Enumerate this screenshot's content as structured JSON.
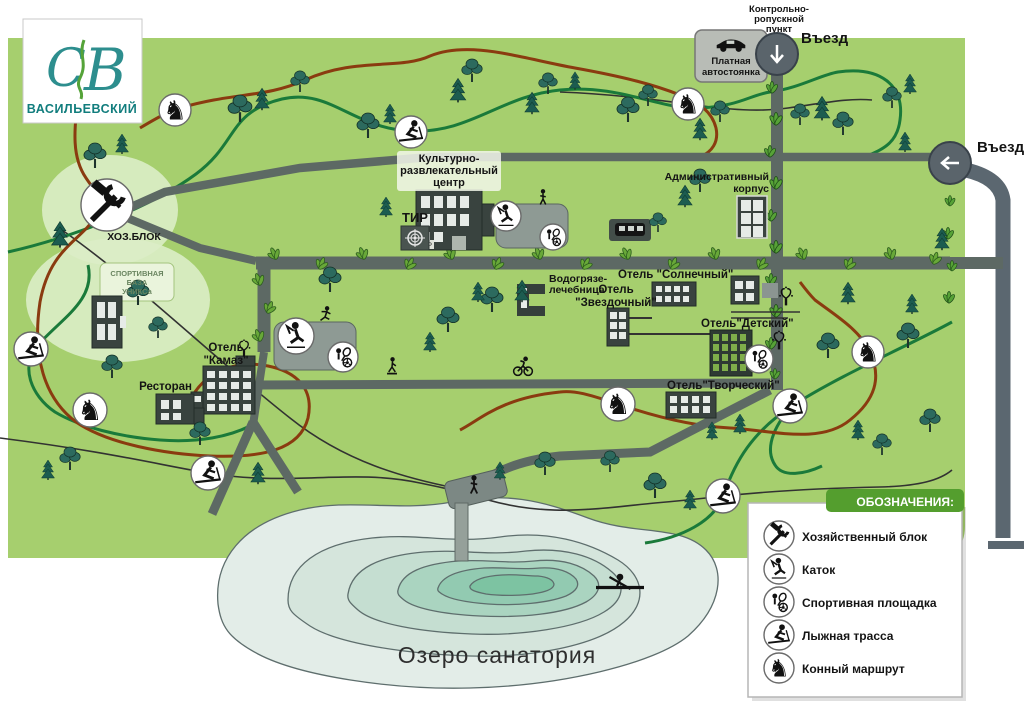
{
  "logo": {
    "monogram_c": "С",
    "monogram_v": "В",
    "name": "ВАСИЛЬЕВСКИЙ"
  },
  "entrances": {
    "top_label": "Въезд",
    "right_label": "Въезд",
    "checkpoint_lines": [
      "Контрольно-",
      "ропускной",
      "пункт"
    ],
    "parking_lines": [
      "Платная",
      "автостоянка"
    ]
  },
  "places": {
    "cultural_lines": [
      "Культурно-",
      "развлекательный",
      "центр"
    ],
    "bar": "БАР",
    "tir": "ТИР",
    "admin_lines": [
      "Административный",
      "корпус"
    ],
    "hoz": "ХОЗ.БЛОК",
    "sport_base_lines": [
      "СПОРТИВНАЯ",
      "БАЗА",
      "УНИКСа"
    ],
    "clinic_lines": [
      "Водогрязе-",
      "лечебница"
    ],
    "hotel_sunny": "Отель \"Солнечный\"",
    "hotel_star_lines": [
      "Отель",
      "\"Звездочный\""
    ],
    "hotel_kids": "Отель\"Детский\"",
    "hotel_creative": "Отель\"Творческий\"",
    "hotel_kamaz_lines": [
      "Отель",
      "\"Камаз\""
    ],
    "restaurant": "Ресторан",
    "lake": "Озеро  санатория"
  },
  "legend": {
    "title": "ОБОЗНАЧЕНИЯ:",
    "items": [
      {
        "icon": "tools-icon",
        "label": "Хозяйственный блок"
      },
      {
        "icon": "skate-icon",
        "label": "Каток"
      },
      {
        "icon": "sport-icon",
        "label": "Спортивная площадка"
      },
      {
        "icon": "ski-icon",
        "label": "Лыжная трасса"
      },
      {
        "icon": "horse-icon",
        "label": "Конный маршрут"
      }
    ]
  },
  "icons": {
    "horse_glyph": "♞"
  },
  "colors": {
    "map_green": "#a6cf6e",
    "road": "#5d6964",
    "outer_road": "#5b6770",
    "trail_horse": "#8a3b10",
    "trail_ski": "#1a7a3a",
    "lake_rings": [
      "#e3ede8",
      "#d5e5dc",
      "#c5ded1",
      "#aad4c0",
      "#92cab1",
      "#7dc3a2"
    ],
    "legend_green": "#549e2e",
    "logo_teal": "#2d8e8e"
  },
  "map_markers": {
    "trees": [
      [
        240,
        122,
        "d",
        1.4
      ],
      [
        262,
        108,
        "c",
        1.1
      ],
      [
        300,
        92,
        "d",
        1.1
      ],
      [
        368,
        138,
        "d",
        1.3
      ],
      [
        390,
        122,
        "c",
        1.0
      ],
      [
        458,
        100,
        "c",
        1.2
      ],
      [
        472,
        82,
        "d",
        1.2
      ],
      [
        532,
        112,
        "c",
        1.1
      ],
      [
        548,
        94,
        "d",
        1.1
      ],
      [
        575,
        88,
        "c",
        0.9
      ],
      [
        628,
        122,
        "d",
        1.3
      ],
      [
        648,
        106,
        "d",
        1.1
      ],
      [
        700,
        138,
        "c",
        1.1
      ],
      [
        720,
        122,
        "d",
        1.1
      ],
      [
        800,
        125,
        "d",
        1.1
      ],
      [
        822,
        118,
        "c",
        1.2
      ],
      [
        843,
        135,
        "d",
        1.2
      ],
      [
        905,
        150,
        "c",
        1.0
      ],
      [
        910,
        92,
        "c",
        1.0
      ],
      [
        892,
        108,
        "d",
        1.1
      ],
      [
        95,
        168,
        "d",
        1.3
      ],
      [
        122,
        152,
        "c",
        1.0
      ],
      [
        60,
        245,
        "c",
        1.3
      ],
      [
        138,
        305,
        "d",
        1.3
      ],
      [
        158,
        338,
        "d",
        1.1
      ],
      [
        112,
        378,
        "d",
        1.2
      ],
      [
        70,
        470,
        "d",
        1.2
      ],
      [
        48,
        478,
        "c",
        1.0
      ],
      [
        200,
        445,
        "d",
        1.2
      ],
      [
        258,
        482,
        "c",
        1.1
      ],
      [
        330,
        292,
        "d",
        1.3
      ],
      [
        386,
        215,
        "c",
        1.0
      ],
      [
        448,
        332,
        "d",
        1.3
      ],
      [
        430,
        350,
        "c",
        1.0
      ],
      [
        492,
        312,
        "d",
        1.3
      ],
      [
        478,
        300,
        "c",
        1.0
      ],
      [
        522,
        300,
        "c",
        1.1
      ],
      [
        545,
        475,
        "d",
        1.2
      ],
      [
        500,
        478,
        "c",
        0.9
      ],
      [
        610,
        472,
        "d",
        1.1
      ],
      [
        655,
        498,
        "d",
        1.3
      ],
      [
        690,
        508,
        "c",
        1.0
      ],
      [
        715,
        500,
        "c",
        0.9
      ],
      [
        740,
        432,
        "c",
        1.0
      ],
      [
        712,
        438,
        "c",
        0.9
      ],
      [
        828,
        358,
        "d",
        1.3
      ],
      [
        848,
        302,
        "c",
        1.1
      ],
      [
        908,
        348,
        "d",
        1.3
      ],
      [
        912,
        312,
        "c",
        1.0
      ],
      [
        942,
        248,
        "c",
        1.1
      ],
      [
        930,
        432,
        "d",
        1.2
      ],
      [
        858,
        438,
        "c",
        1.0
      ],
      [
        882,
        455,
        "d",
        1.1
      ],
      [
        685,
        205,
        "c",
        1.1
      ],
      [
        700,
        192,
        "d",
        1.2
      ],
      [
        658,
        232,
        "d",
        1.0
      ]
    ],
    "bushes": [
      [
        763,
        60,
        1.2
      ],
      [
        786,
        62,
        1.1
      ],
      [
        772,
        92,
        1.0
      ],
      [
        776,
        124,
        1.1
      ],
      [
        770,
        156,
        1.0
      ],
      [
        776,
        188,
        1.1
      ],
      [
        771,
        220,
        1.0
      ],
      [
        776,
        252,
        1.1
      ],
      [
        771,
        284,
        1.0
      ],
      [
        776,
        316,
        1.1
      ],
      [
        771,
        348,
        1.0
      ],
      [
        775,
        378,
        0.9
      ],
      [
        950,
        205,
        0.9
      ],
      [
        948,
        238,
        1.0
      ],
      [
        952,
        270,
        0.9
      ],
      [
        949,
        302,
        1.0
      ]
    ],
    "alley_leaves": [
      [
        276,
        258,
        -25,
        1.3
      ],
      [
        320,
        268,
        20,
        1.3
      ],
      [
        364,
        258,
        -20,
        1.3
      ],
      [
        408,
        268,
        25,
        1.3
      ],
      [
        452,
        258,
        -25,
        1.3
      ],
      [
        496,
        268,
        20,
        1.3
      ],
      [
        540,
        258,
        -20,
        1.3
      ],
      [
        584,
        268,
        25,
        1.3
      ],
      [
        628,
        258,
        -25,
        1.3
      ],
      [
        672,
        268,
        20,
        1.3
      ],
      [
        716,
        258,
        -20,
        1.3
      ],
      [
        760,
        268,
        25,
        1.3
      ],
      [
        804,
        258,
        -25,
        1.3
      ],
      [
        848,
        268,
        20,
        1.3
      ],
      [
        892,
        258,
        -20,
        1.3
      ],
      [
        934,
        263,
        15,
        1.3
      ],
      [
        260,
        284,
        -20,
        1.3
      ],
      [
        268,
        312,
        20,
        1.3
      ],
      [
        260,
        340,
        -20,
        1.3
      ]
    ],
    "fountains": [
      [
        244,
        349,
        1.1
      ],
      [
        786,
        297,
        1.2
      ],
      [
        779,
        341,
        1.2
      ]
    ],
    "figures": [
      [
        474,
        487,
        "walk",
        1.3
      ],
      [
        543,
        199,
        "walk",
        1.1
      ],
      [
        326,
        316,
        "skate",
        1.1
      ],
      [
        392,
        367,
        "sk8",
        1.1
      ],
      [
        523,
        366,
        "cyc",
        1.3
      ],
      [
        620,
        586,
        "row",
        1.5
      ]
    ],
    "icon_circles": [
      {
        "x": 107,
        "y": 205,
        "r": 26,
        "glyph": "tools"
      },
      {
        "x": 175,
        "y": 110,
        "r": 16,
        "glyph": "horse"
      },
      {
        "x": 688,
        "y": 104,
        "r": 16,
        "glyph": "horse"
      },
      {
        "x": 868,
        "y": 352,
        "r": 16,
        "glyph": "horse"
      },
      {
        "x": 618,
        "y": 404,
        "r": 17,
        "glyph": "horse"
      },
      {
        "x": 90,
        "y": 410,
        "r": 17,
        "glyph": "horse"
      },
      {
        "x": 411,
        "y": 132,
        "r": 16,
        "glyph": "ski"
      },
      {
        "x": 31,
        "y": 349,
        "r": 17,
        "glyph": "ski"
      },
      {
        "x": 208,
        "y": 473,
        "r": 17,
        "glyph": "ski"
      },
      {
        "x": 723,
        "y": 496,
        "r": 17,
        "glyph": "ski"
      },
      {
        "x": 790,
        "y": 406,
        "r": 17,
        "glyph": "ski"
      },
      {
        "x": 506,
        "y": 216,
        "r": 15,
        "glyph": "skate"
      },
      {
        "x": 296,
        "y": 336,
        "r": 18,
        "glyph": "skate"
      },
      {
        "x": 553,
        "y": 237,
        "r": 13,
        "glyph": "sport"
      },
      {
        "x": 343,
        "y": 357,
        "r": 15,
        "glyph": "sport"
      },
      {
        "x": 759,
        "y": 359,
        "r": 14,
        "glyph": "sport"
      }
    ]
  }
}
